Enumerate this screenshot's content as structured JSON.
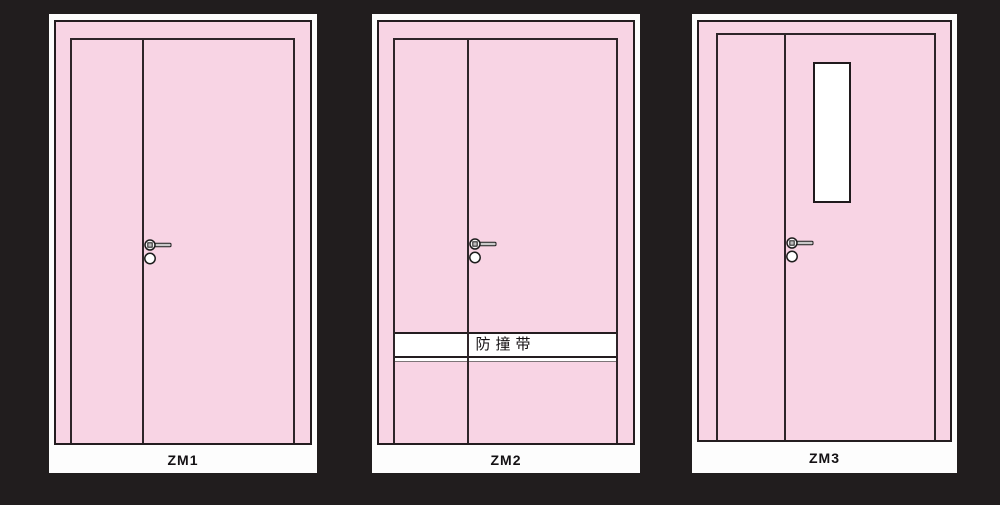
{
  "colors": {
    "background": "#211d1e",
    "card": "#fdfdfd",
    "door_pink": "#f8d4e4",
    "outline": "#241d20",
    "band_fill": "#ffffff",
    "handle_metal": "#c9c9c9"
  },
  "doors": [
    {
      "code": "ZM1"
    },
    {
      "code": "ZM2",
      "band_label": "防撞带"
    },
    {
      "code": "ZM3"
    }
  ]
}
